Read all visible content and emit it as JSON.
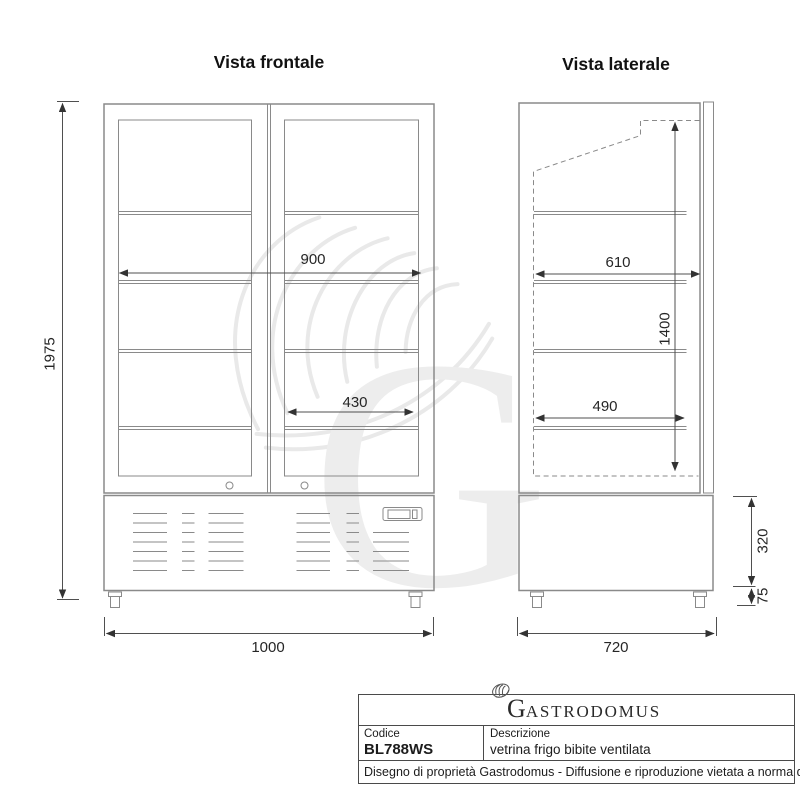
{
  "front_view": {
    "title": "Vista frontale",
    "dim_height": "1975",
    "dim_inner_width": "900",
    "dim_shelf_width": "430",
    "dim_total_width": "1000"
  },
  "side_view": {
    "title": "Vista laterale",
    "dim_inner_depth": "610",
    "dim_inner_height": "1400",
    "dim_shelf_depth": "490",
    "dim_base_height": "320",
    "dim_caster_height": "75",
    "dim_total_depth": "720"
  },
  "title_block": {
    "logo_initial": "G",
    "logo_rest": "ASTRODOMUS",
    "codice_label": "Codice",
    "codice_value": "BL788WS",
    "descrizione_label": "Descrizione",
    "descrizione_value": "vetrina frigo bibite ventilata",
    "footer": "Disegno di proprietà Gastrodomus - Diffusione e riproduzione vietata a norma di legge."
  },
  "watermark": {
    "letter": "G"
  },
  "colors": {
    "drawing_line": "#8a8a8a",
    "dimension_line": "#4f4f4f",
    "arrow": "#333333",
    "text": "#262626",
    "table_border": "#4a4a4a",
    "watermark": "#ededed",
    "background": "#ffffff"
  }
}
